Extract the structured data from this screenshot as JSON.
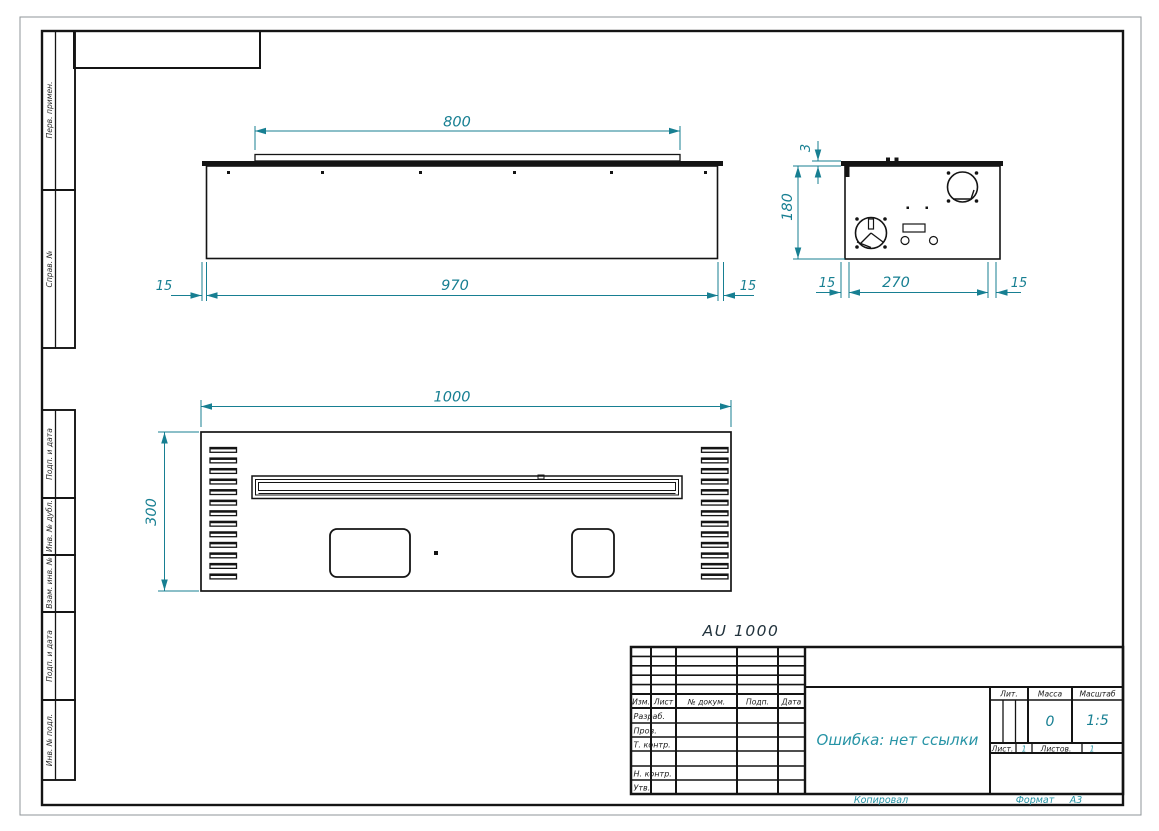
{
  "margin_labels": [
    "Перв. примен.",
    "Справ. №",
    "Подп. и дата",
    "Инв. № дубл.",
    "Взам. инв. №",
    "Подп. и дата",
    "Инв. № подл."
  ],
  "views": {
    "top": {
      "dim_lip": "800",
      "dim_body": "970",
      "dim_left": "15",
      "dim_right": "15"
    },
    "side": {
      "dim_lip_height": "3",
      "dim_height": "180",
      "dim_left": "15",
      "dim_width": "270",
      "dim_right": "15"
    },
    "front": {
      "dim_width": "1000",
      "dim_height": "300"
    }
  },
  "model_label": "AU 1000",
  "title_block": {
    "header": {
      "izm": "Изм.",
      "list": "Лист",
      "dokum": "№ докум.",
      "podp": "Подп.",
      "data": "Дата"
    },
    "rows": {
      "razrab": "Разраб.",
      "prov": "Пров.",
      "t_kontr": "Т. контр.",
      "n_kontr": "Н. контр.",
      "utv": "Утв."
    },
    "name": "Ошибка: нет ссылки",
    "lit_label": "Лит.",
    "massa_label": "Масса",
    "masshtab_label": "Масштаб",
    "massa_value": "0",
    "masshtab_value": "1:5",
    "list_label": "Лист.",
    "list_value": "1",
    "listov_label": "Листов.",
    "listov_value": "1"
  },
  "footer": {
    "kopiroval": "Копировал",
    "format_label": "Формат",
    "format_value": "А3"
  },
  "colors": {
    "dimension": "#177f92",
    "ink": "#141414",
    "annotation": "#2794a6"
  }
}
